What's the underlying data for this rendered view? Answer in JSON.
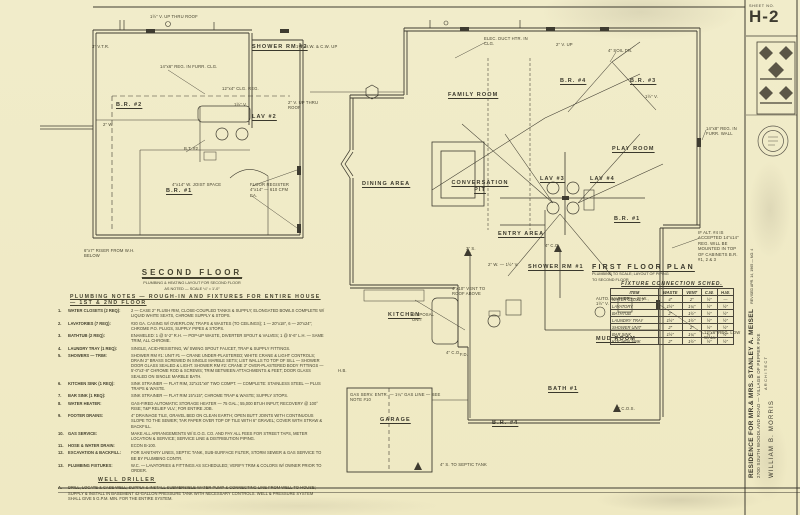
{
  "sheet": {
    "label": "SHEET NO.",
    "number": "H-2"
  },
  "title_block": {
    "project": "RESIDENCE FOR MR.& MRS. STANLEY A. MEISEL",
    "revision": "REVISED APR. 14, 1965 — NO. 4",
    "address": "2700 SOUTH WOODLAND ROAD — VILLAGE OF PEPPER PIKE",
    "role": "ARCHITECT",
    "architect": "WILLIAM B. MORRIS"
  },
  "labels": {
    "shower_rm_2": "SHOWER RM #2",
    "lav_2": "LAV #2",
    "br_2": "B.R. #2",
    "br_1_sf": "B.R. #1",
    "family_room": "FAMILY ROOM",
    "play_room": "PLAY ROOM",
    "dining_area": "DINING AREA",
    "conversation_pit": "CONVERSATION PIT",
    "entry_area": "ENTRY AREA",
    "kitchen": "KITCHEN",
    "mud_room": "MUD ROOM",
    "bath_1": "BATH #1",
    "garage": "GARAGE",
    "br_1": "B.R. #1",
    "br_3": "B.R. #3",
    "br_4": "B.R. #4",
    "br_4b": "B.R. #4",
    "lav_3": "LAV #3",
    "lav_4": "LAV #4",
    "shower_rm_1": "SHOWER RM #1"
  },
  "second_floor_title": {
    "title": "SECOND FLOOR",
    "sub1": "PLUMBING & HEATING LAYOUT FOR SECOND FLOOR",
    "sub2": "AS NOTED — SCALE ¼″ = 1′-0″"
  },
  "first_floor_title": {
    "title": "FIRST FLOOR PLAN",
    "sub1": "PLUMBING TO SCALE; LAYOUT OF PIPING",
    "sub2": "TO SECOND FLOOR"
  },
  "plumbing_notes": {
    "heading": "PLUMBING NOTES — ROUGH-IN AND FIXTURES FOR ENTIRE HOUSE — 1ST & 2ND FLOOR",
    "items": [
      {
        "num": "1.",
        "title": "WATER CLOSETS (2 REQ):",
        "body": "2 — CASE 2″ FLUSH RIM, CLOSE-COUPLED TANKS & SUPPLY; ELONGATED BOWLS COMPLETE W/ LIQUID WHITE SEATS, CHROME SUPPLY & STOPS."
      },
      {
        "num": "2.",
        "title": "LAVATORIES (7 REQ):",
        "body": "#20 GA. CASING W/ OVERFLOW, TRAPS & WASTES (TO CEILINGS); 1 — 20″x18″, 6 — 20″x24″; CHROME P.O. PLUGS, SUPPLY PIPES & STOPS."
      },
      {
        "num": "3.",
        "title": "BATHTUB (2 REQ):",
        "body": "ENAMELED: 1 @ 5′-2″ R.H. — POP-UP WASTE, DIVERTER SPOUT & VALVES; 1 @ 5′-6″ L.H. — SAME TRIM, ALL CHROME."
      },
      {
        "num": "4.",
        "title": "LAUNDRY TRAY (1 REQ):",
        "body": "SINGLE, ACID-RESISTING, W/ SWING SPOUT FAUCET, TRAP & SUPPLY FITTINGS."
      },
      {
        "num": "5.",
        "title": "SHOWERS — TRIM:",
        "body": "SHOWER RM #1: UNIT #1 — CRANE UNDER-PLASTERED; WHITE CRANE & LIGHT CONTROLS; DRAIN 2″ BRASS SCREWED IN SINGLE MARBLE SETS; LIST WALLS TO TOP OF SILL — SHOWER DOOR GLASS SEALED & LIGHT. SHOWER RM #2: CRANE 3″ OVER-PLASTERED BODY FITTINGS — 5′-0″x3′-8″ CHROME ROD & SCREWS; TRIM BETWEEN ATTACHMENTS & FEET; DOOR GLASS SEALED ON SINGLE MARBLE BATH."
      },
      {
        "num": "6.",
        "title": "KITCHEN SINK (1 REQ):",
        "body": "SINK STRAINER — FLAT RIM, 32″x21″x8″ TWO COMPT. — COMPLETE: STAINLESS STEEL — PLUS TRAPS & WASTE."
      },
      {
        "num": "7.",
        "title": "BAR SINK (1 REQ):",
        "body": "SINK STRAINER — FLAT RIM 15″x15″; CHROME TRAP & WASTE; SUPPLY STOPS."
      },
      {
        "num": "8.",
        "title": "WATER HEATER:",
        "body": "GAS-FIRED AUTOMATIC STORAGE HEATER — 75 GAL.; 55,000 BTUH INPUT; RECOVERY @ 100° RISE; T&P RELIEF VLV.; FOR ENTIRE JOB."
      },
      {
        "num": "9.",
        "title": "FOOTER DRAINS:",
        "body": "4″ DRAINAGE TILE, GRAVEL BED ON CLEAN EARTH; OPEN BUTT JOINTS WITH CONTINUOUS SLOPE TO THE SEWER; TAR PAPER OVER TOP OF TILE WITH 6″ GRAVEL; COVER WITH STRAW & BACKFILL."
      },
      {
        "num": "10.",
        "title": "GAS SERVICE:",
        "body": "MAKE ALL ARRANGEMENTS W/ E.O.G. CO. AND PAY ALL FEES FOR STREET TAPS, METER LOCATION & SERVICE; SERVICE LINE & DISTRIBUTION PIPING."
      },
      {
        "num": "11.",
        "title": "HOSE & WATER DRAIN:",
        "body": "ECON B-100."
      },
      {
        "num": "12.",
        "title": "EXCAVATION & BACKFILL:",
        "body": "FOR SANITARY LINES, SEPTIC TANK, SUB-SURFACE FILTER, STORM SEWER & GAS SERVICE TO BE BY PLUMBING CONTR."
      },
      {
        "num": "13.",
        "title": "PLUMBING FIXTURES:",
        "body": "W.C. — LAVATORIES & FITTINGS AS SCHEDULED; VERIFY TRIM & COLORS W/ OWNER PRIOR TO ORDER."
      }
    ],
    "well_heading": "WELL DRILLER",
    "well_items": [
      {
        "num": "A.",
        "body": "DRILL, LOCATE & CASE WELL; SUPPLY & INSTALL SUBMERSIBLE WATER PUMP & CONNECTING LINE FROM WELL TO HOUSE; SUPPLY & INSTALL IN BASEMENT 42-GALLON PRESSURE TANK WITH NECESSARY CONTROLS. WELL & PRESSURE SYSTEM SHALL GIVE 5 G.P.M. MIN. FOR THE ENTIRE SYSTEM."
      }
    ]
  },
  "fixture_table": {
    "title": "FIXTURE CONNECTION SCHED.",
    "headers": [
      "ITEM",
      "WASTE",
      "VENT",
      "C.W.",
      "H.W."
    ],
    "rows": [
      [
        "WATER CLOSET",
        "4″",
        "2″",
        "½″",
        "—"
      ],
      [
        "LAVATORY",
        "1½″",
        "1¼″",
        "½″",
        "½″"
      ],
      [
        "BATHTUB",
        "2″",
        "1½″",
        "½″",
        "½″"
      ],
      [
        "LAUNDRY TRAY",
        "1½″",
        "1½″",
        "½″",
        "½″"
      ],
      [
        "SHOWER UNIT",
        "2″",
        "2″",
        "½″",
        "½″"
      ],
      [
        "BAR SINK",
        "1½″",
        "1¼″",
        "½″",
        "½″"
      ],
      [
        "KITCHEN SINK",
        "2″",
        "1½″",
        "½″",
        "½″"
      ]
    ]
  },
  "annotations": [
    "3″ V.T.R.",
    "1½″ V. UP THRU ROOF",
    "14″x6″ REG. IN FURR. CLG.",
    "12″x4″ CLG. REG.",
    "2″ W.",
    "B.T. #2",
    "4″x14″ W. JOIST SPACE",
    "FLOOR REGISTER 4″x14″ — 610 CFM EA.",
    "6″x7″ RISER FROM W.H. BELOW",
    "1½″ V.",
    "2″ V. UP THRU ROOF",
    "1¼″ H.W. & C.W. UP",
    "ELEC. DUCT HTR. IN CLG.",
    "4″ SOIL DN.",
    "2″ V. UP",
    "IF ALT. #4 IS ACCEPTED 14″x14″ REG. WILL BE MOUNTED IN TOP OF CABINETS B.R. #1, 2 & 3",
    "4″ C.O.",
    "3″ S.",
    "2″ W. — 1½″ V.",
    "4″x10″ VENT TO ROOF ABOVE",
    "DISPOSAL UNIT",
    "F.D.",
    "AUTO. WASHER — 2″ W., 1½″ V.",
    "4″ C.O.",
    "4″ C.O.S.",
    "4″ S. TO SEPTIC TANK",
    "GAS SERV. ENTR. — 1¼″ GAS LINE — SEE NOTE #10",
    "H.B.",
    "14″x8″ REG. IN FURR. WALL",
    "12″x6″ REG. LOW WALL",
    "1½″ V."
  ]
}
